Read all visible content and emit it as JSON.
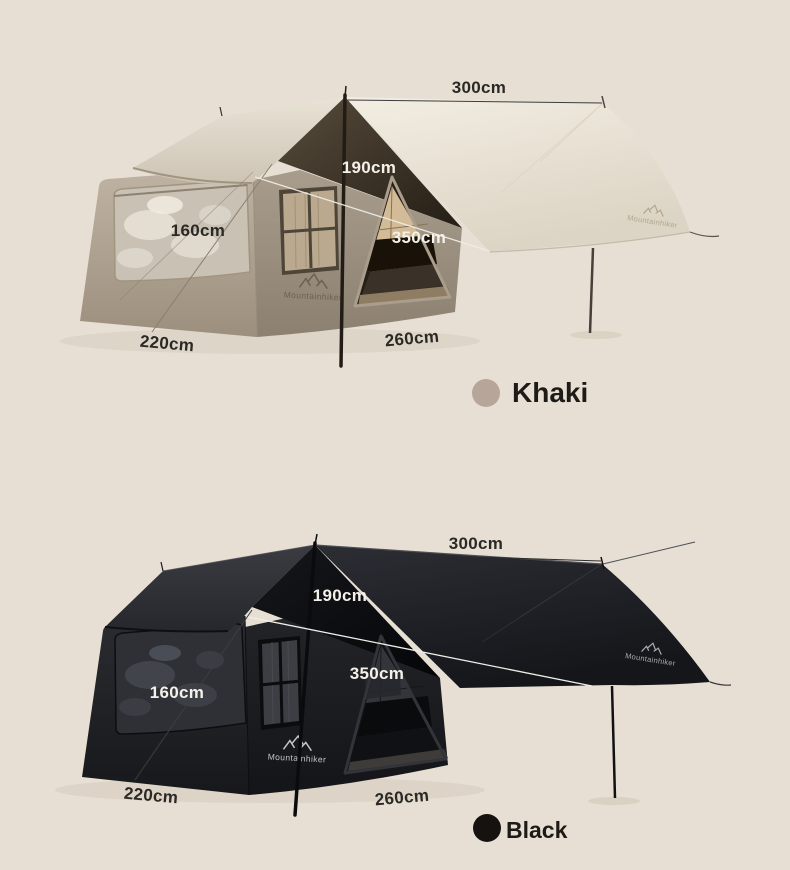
{
  "page": {
    "background": "#e7dfd4"
  },
  "brand": "Mountainhiker",
  "products": [
    {
      "id": "khaki",
      "color_label": "Khaki",
      "swatch_color": "#b8a59a",
      "dims": {
        "tarp_width": "300cm",
        "peak_height": "190cm",
        "total_depth": "350cm",
        "wall_height": "160cm",
        "side_width": "220cm",
        "front_width": "260cm"
      }
    },
    {
      "id": "black",
      "color_label": "Black",
      "swatch_color": "#161210",
      "dims": {
        "tarp_width": "300cm",
        "peak_height": "190cm",
        "total_depth": "350cm",
        "wall_height": "160cm",
        "side_width": "220cm",
        "front_width": "260cm"
      }
    }
  ]
}
